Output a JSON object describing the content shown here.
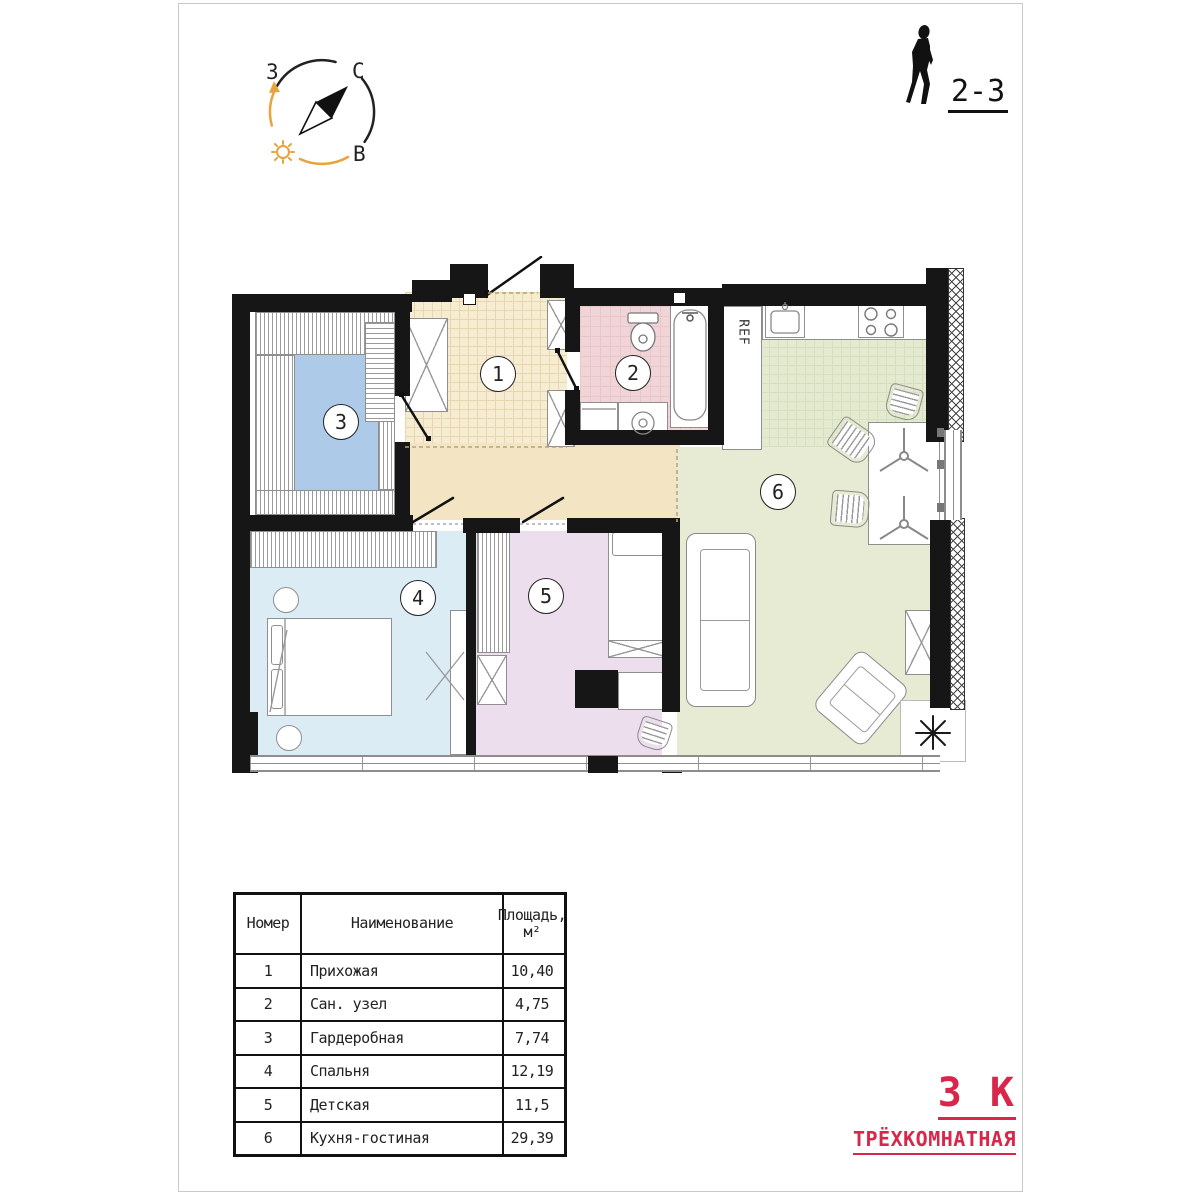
{
  "compass": {
    "west": "З",
    "north": "С",
    "east": "В"
  },
  "person": {
    "floors_label": "2-3"
  },
  "plan": {
    "ref_label": "REF"
  },
  "rooms": [
    {
      "number": "1",
      "name": "Прихожая",
      "area": "10,40"
    },
    {
      "number": "2",
      "name": "Сан. узел",
      "area": "4,75"
    },
    {
      "number": "3",
      "name": "Гардеробная",
      "area": "7,74"
    },
    {
      "number": "4",
      "name": "Спальня",
      "area": "12,19"
    },
    {
      "number": "5",
      "name": "Детская",
      "area": "11,5"
    },
    {
      "number": "6",
      "name": "Кухня-гостиная",
      "area": "29,39"
    }
  ],
  "table": {
    "col_number": "Номер",
    "col_name": "Наименование",
    "col_area_line1": "Площадь,",
    "col_area_line2": "м²"
  },
  "apartment_type": {
    "short": "3 К",
    "full": "ТРЁХКОМНАТНАЯ"
  },
  "colors": {
    "accent_red": "#d8274a",
    "wall_black": "#161616",
    "room1_beige": "#f6ecd2",
    "room2_pink": "#f1d4d7",
    "room3_blue": "#aecae9",
    "room4_lightblue": "#dcecf5",
    "room5_purple": "#ecdeed",
    "room6_green": "#e7ebd3",
    "compass_orange": "#e8a33d"
  }
}
